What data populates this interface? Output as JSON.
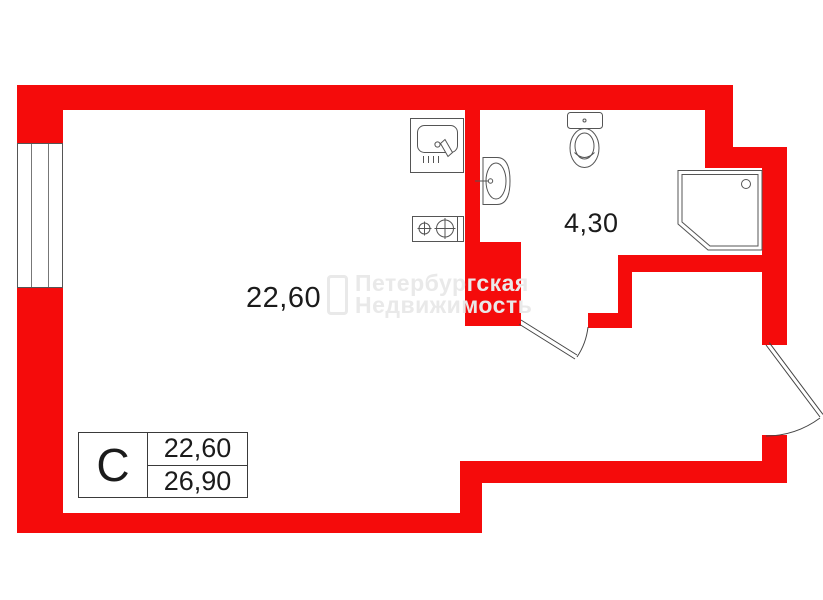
{
  "colors": {
    "wall": "#f50b0b",
    "line": "#555555",
    "door": "#444444",
    "text": "#1b1b1b",
    "watermark": "#e9e9e9"
  },
  "rooms": {
    "main": {
      "area": "22,60"
    },
    "bathroom": {
      "area": "4,30"
    }
  },
  "legend": {
    "type": "С",
    "living_area": "22,60",
    "total_area": "26,90"
  },
  "watermark": {
    "line1": "Петербургская",
    "line2": "Недвижимость"
  },
  "fixtures": [
    "kitchen-sink-icon",
    "stove-icon",
    "bath-sink-icon",
    "toilet-icon",
    "shower-icon",
    "window-icon",
    "bathroom-door-icon",
    "entrance-door-icon"
  ]
}
